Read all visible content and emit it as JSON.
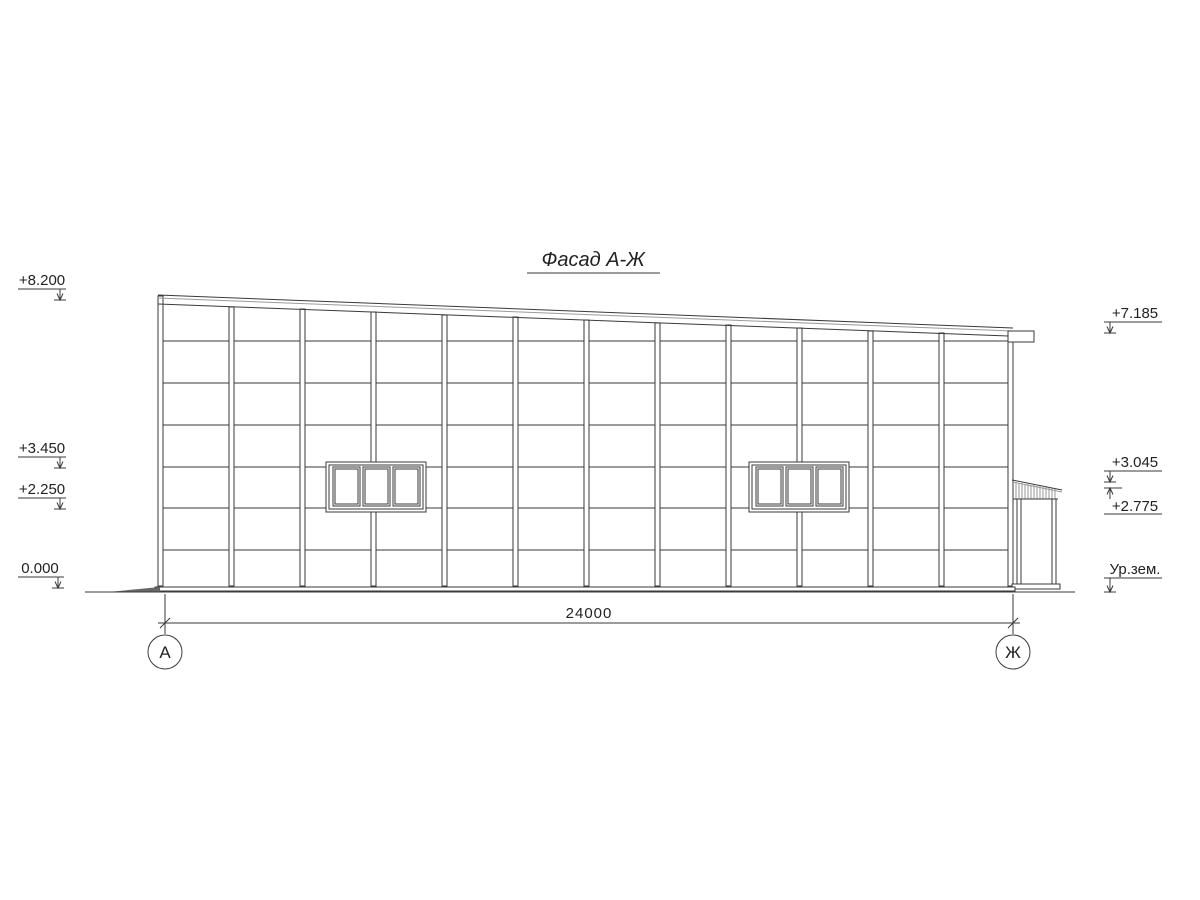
{
  "title": "Фасад А-Ж",
  "drawing_type": "facade elevation",
  "markers_left": [
    {
      "label": "+8.200"
    },
    {
      "label": "+3.450"
    },
    {
      "label": "+2.250"
    },
    {
      "label": "0.000"
    }
  ],
  "markers_right": [
    {
      "label": "+7.185"
    },
    {
      "label": "+3.045"
    },
    {
      "label": "+2.775"
    },
    {
      "label": "Ур.зем."
    }
  ],
  "dimension": {
    "total": "24000"
  },
  "axes": {
    "left": "А",
    "right": "Ж"
  },
  "colors": {
    "line": "#3a3a3a",
    "background": "#ffffff",
    "text": "#222222"
  }
}
